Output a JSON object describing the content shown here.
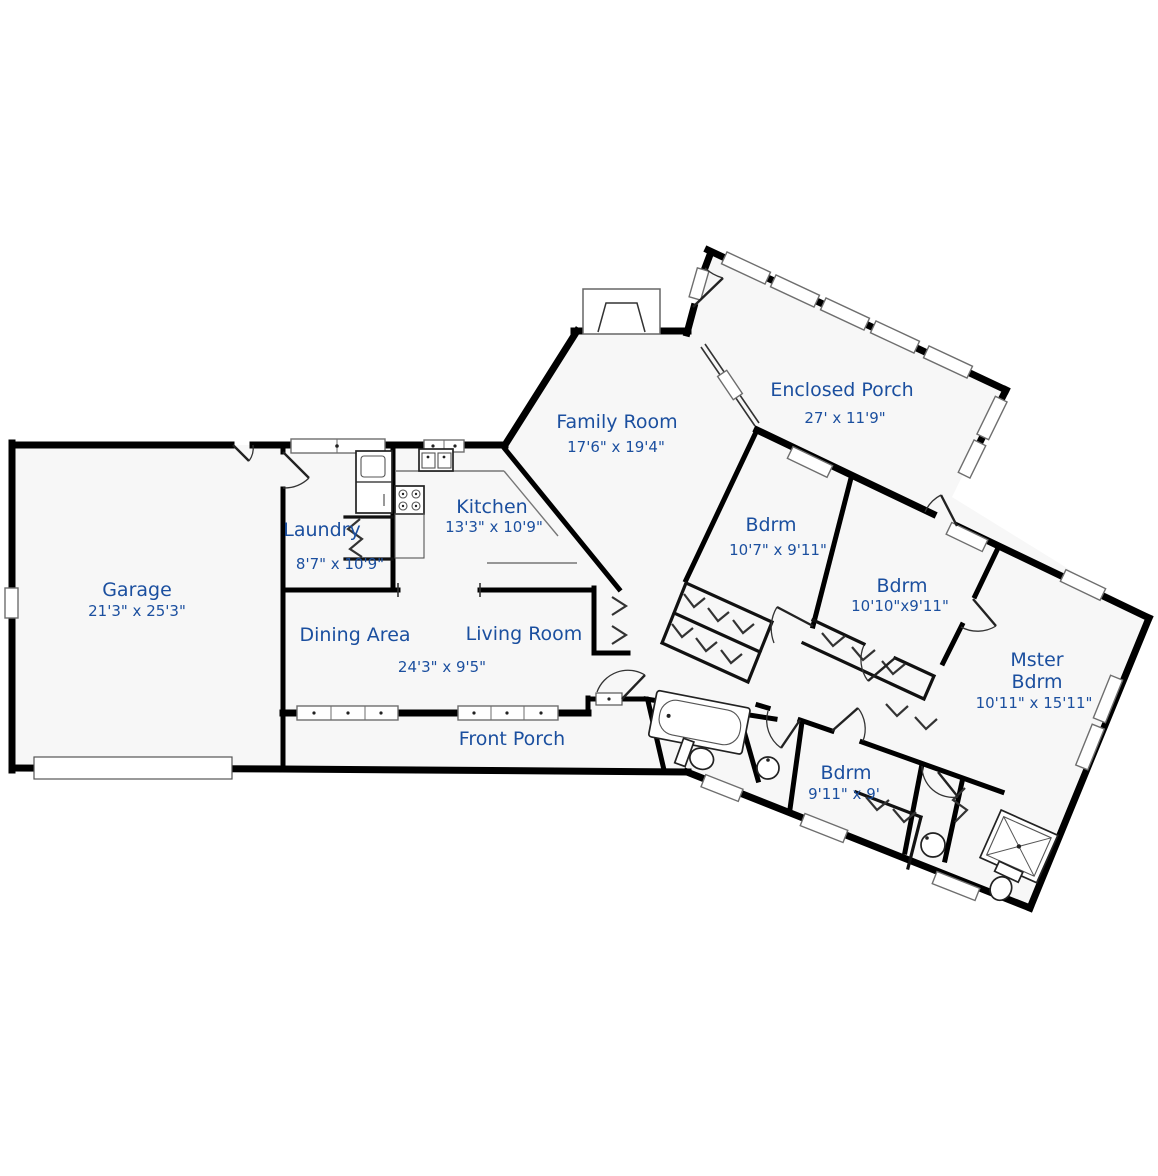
{
  "plan": {
    "type": "residential-floor-plan",
    "colors": {
      "label_blue": "#1b4f9f",
      "wall": "#000000",
      "floor_fill": "#f7f7f7",
      "window_border": "#6e6e6e"
    },
    "rooms": {
      "garage": {
        "name": "Garage",
        "dims": "21'3\" x 25'3\""
      },
      "laundry": {
        "name": "Laundry",
        "dims": "8'7\" x 10'9\""
      },
      "kitchen": {
        "name": "Kitchen",
        "dims": "13'3\" x 10'9\""
      },
      "family_room": {
        "name": "Family Room",
        "dims": "17'6\" x 19'4\""
      },
      "enclosed_porch": {
        "name": "Enclosed Porch",
        "dims": "27' x 11'9\""
      },
      "bedroom1": {
        "name": "Bdrm",
        "dims": "10'7\" x 9'11\""
      },
      "bedroom2": {
        "name": "Bdrm",
        "dims": "10'10\"x9'11\""
      },
      "master_bedroom": {
        "name_line1": "Mster",
        "name_line2": "Bdrm",
        "dims": "10'11\" x 15'11\""
      },
      "bedroom3": {
        "name": "Bdrm",
        "dims": "9'11\" x 9'"
      },
      "dining_area": {
        "name": "Dining Area"
      },
      "living_room": {
        "name": "Living Room"
      },
      "dining_living": {
        "dims": "24'3\" x 9'5\""
      },
      "front_porch": {
        "name": "Front Porch"
      }
    },
    "fixtures": [
      "fireplace-icon",
      "washer-dryer-icon",
      "stove-icon",
      "kitchen-sink-icon",
      "bathtub-icon",
      "toilet-icon",
      "shower-icon",
      "bathroom-sink-icon",
      "closet-rod-icon",
      "garage-door-icon",
      "window-icon",
      "door-swing-icon"
    ]
  }
}
